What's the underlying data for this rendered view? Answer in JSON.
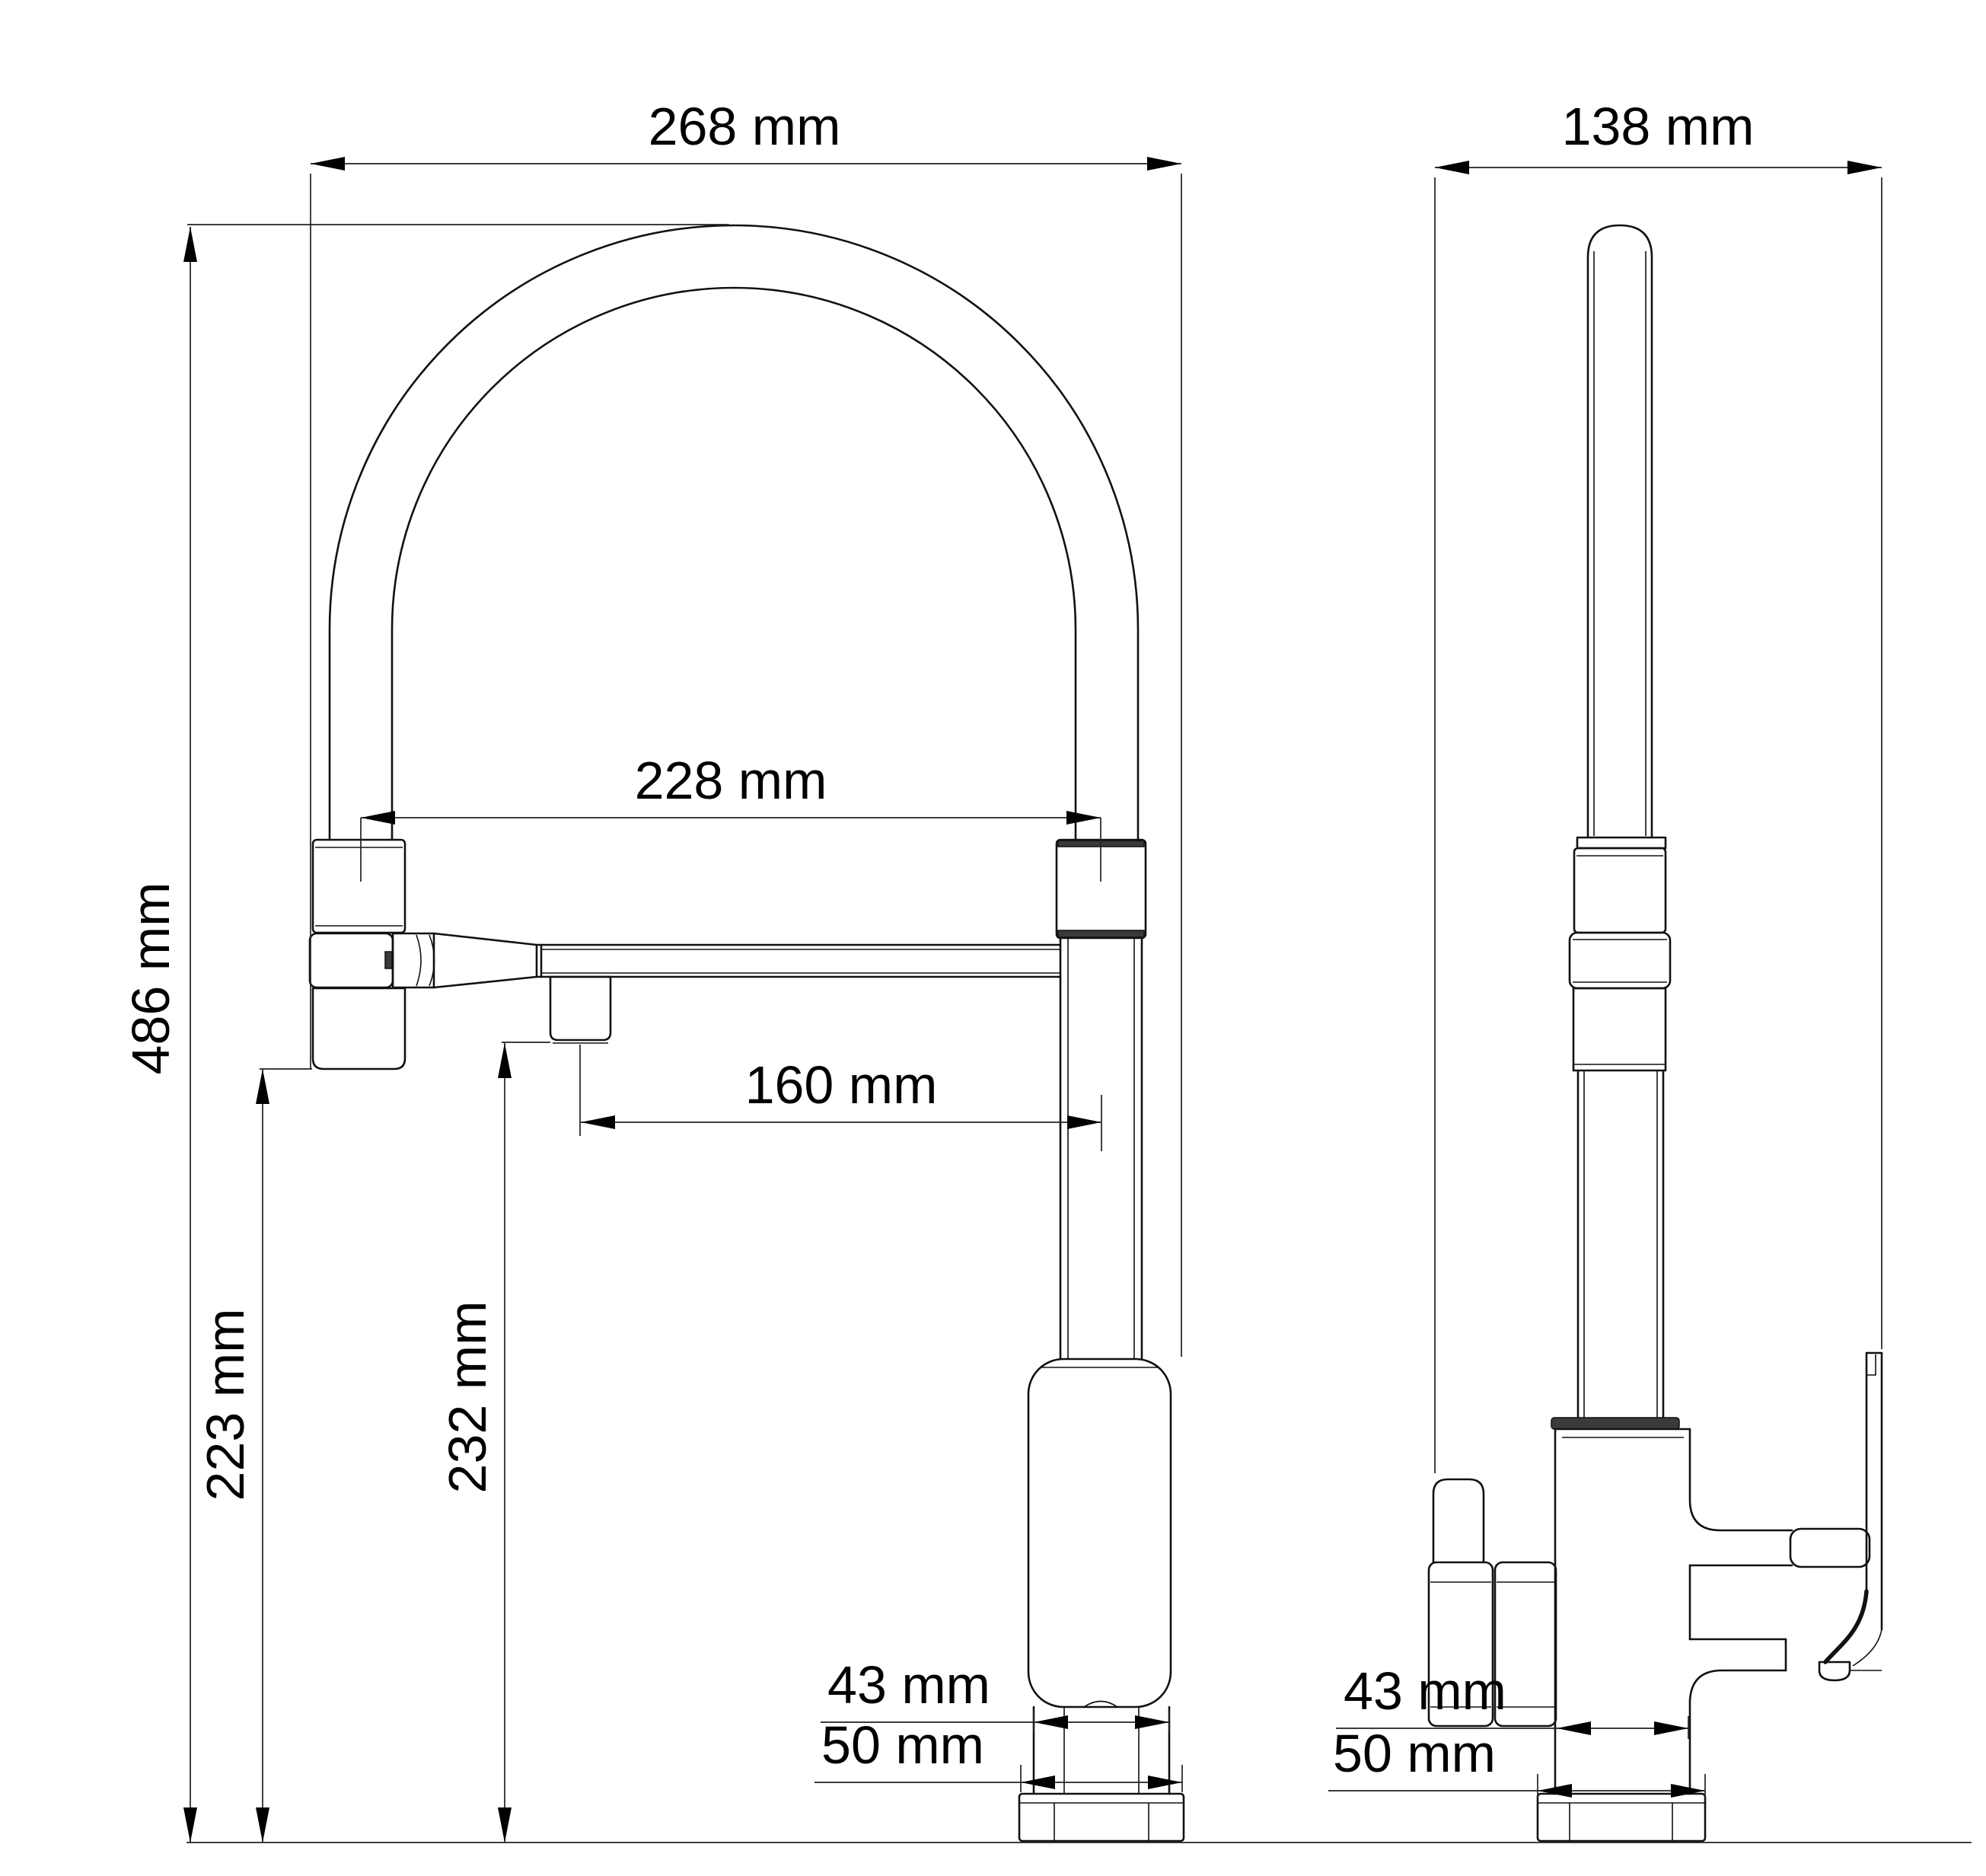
{
  "drawing": {
    "unit": "mm",
    "background_color": "#ffffff",
    "line_color": "#111111",
    "front_view": {
      "overall_width": "268 mm",
      "hose_span": "228 mm",
      "spout_reach": "160 mm",
      "overall_height": "486 mm",
      "spray_head_clearance": "223 mm",
      "spout_outlet_height": "232 mm",
      "body_width": "43 mm",
      "base_width": "50 mm"
    },
    "side_view": {
      "overall_depth": "138 mm",
      "body_width": "43 mm",
      "base_width": "50 mm"
    }
  }
}
